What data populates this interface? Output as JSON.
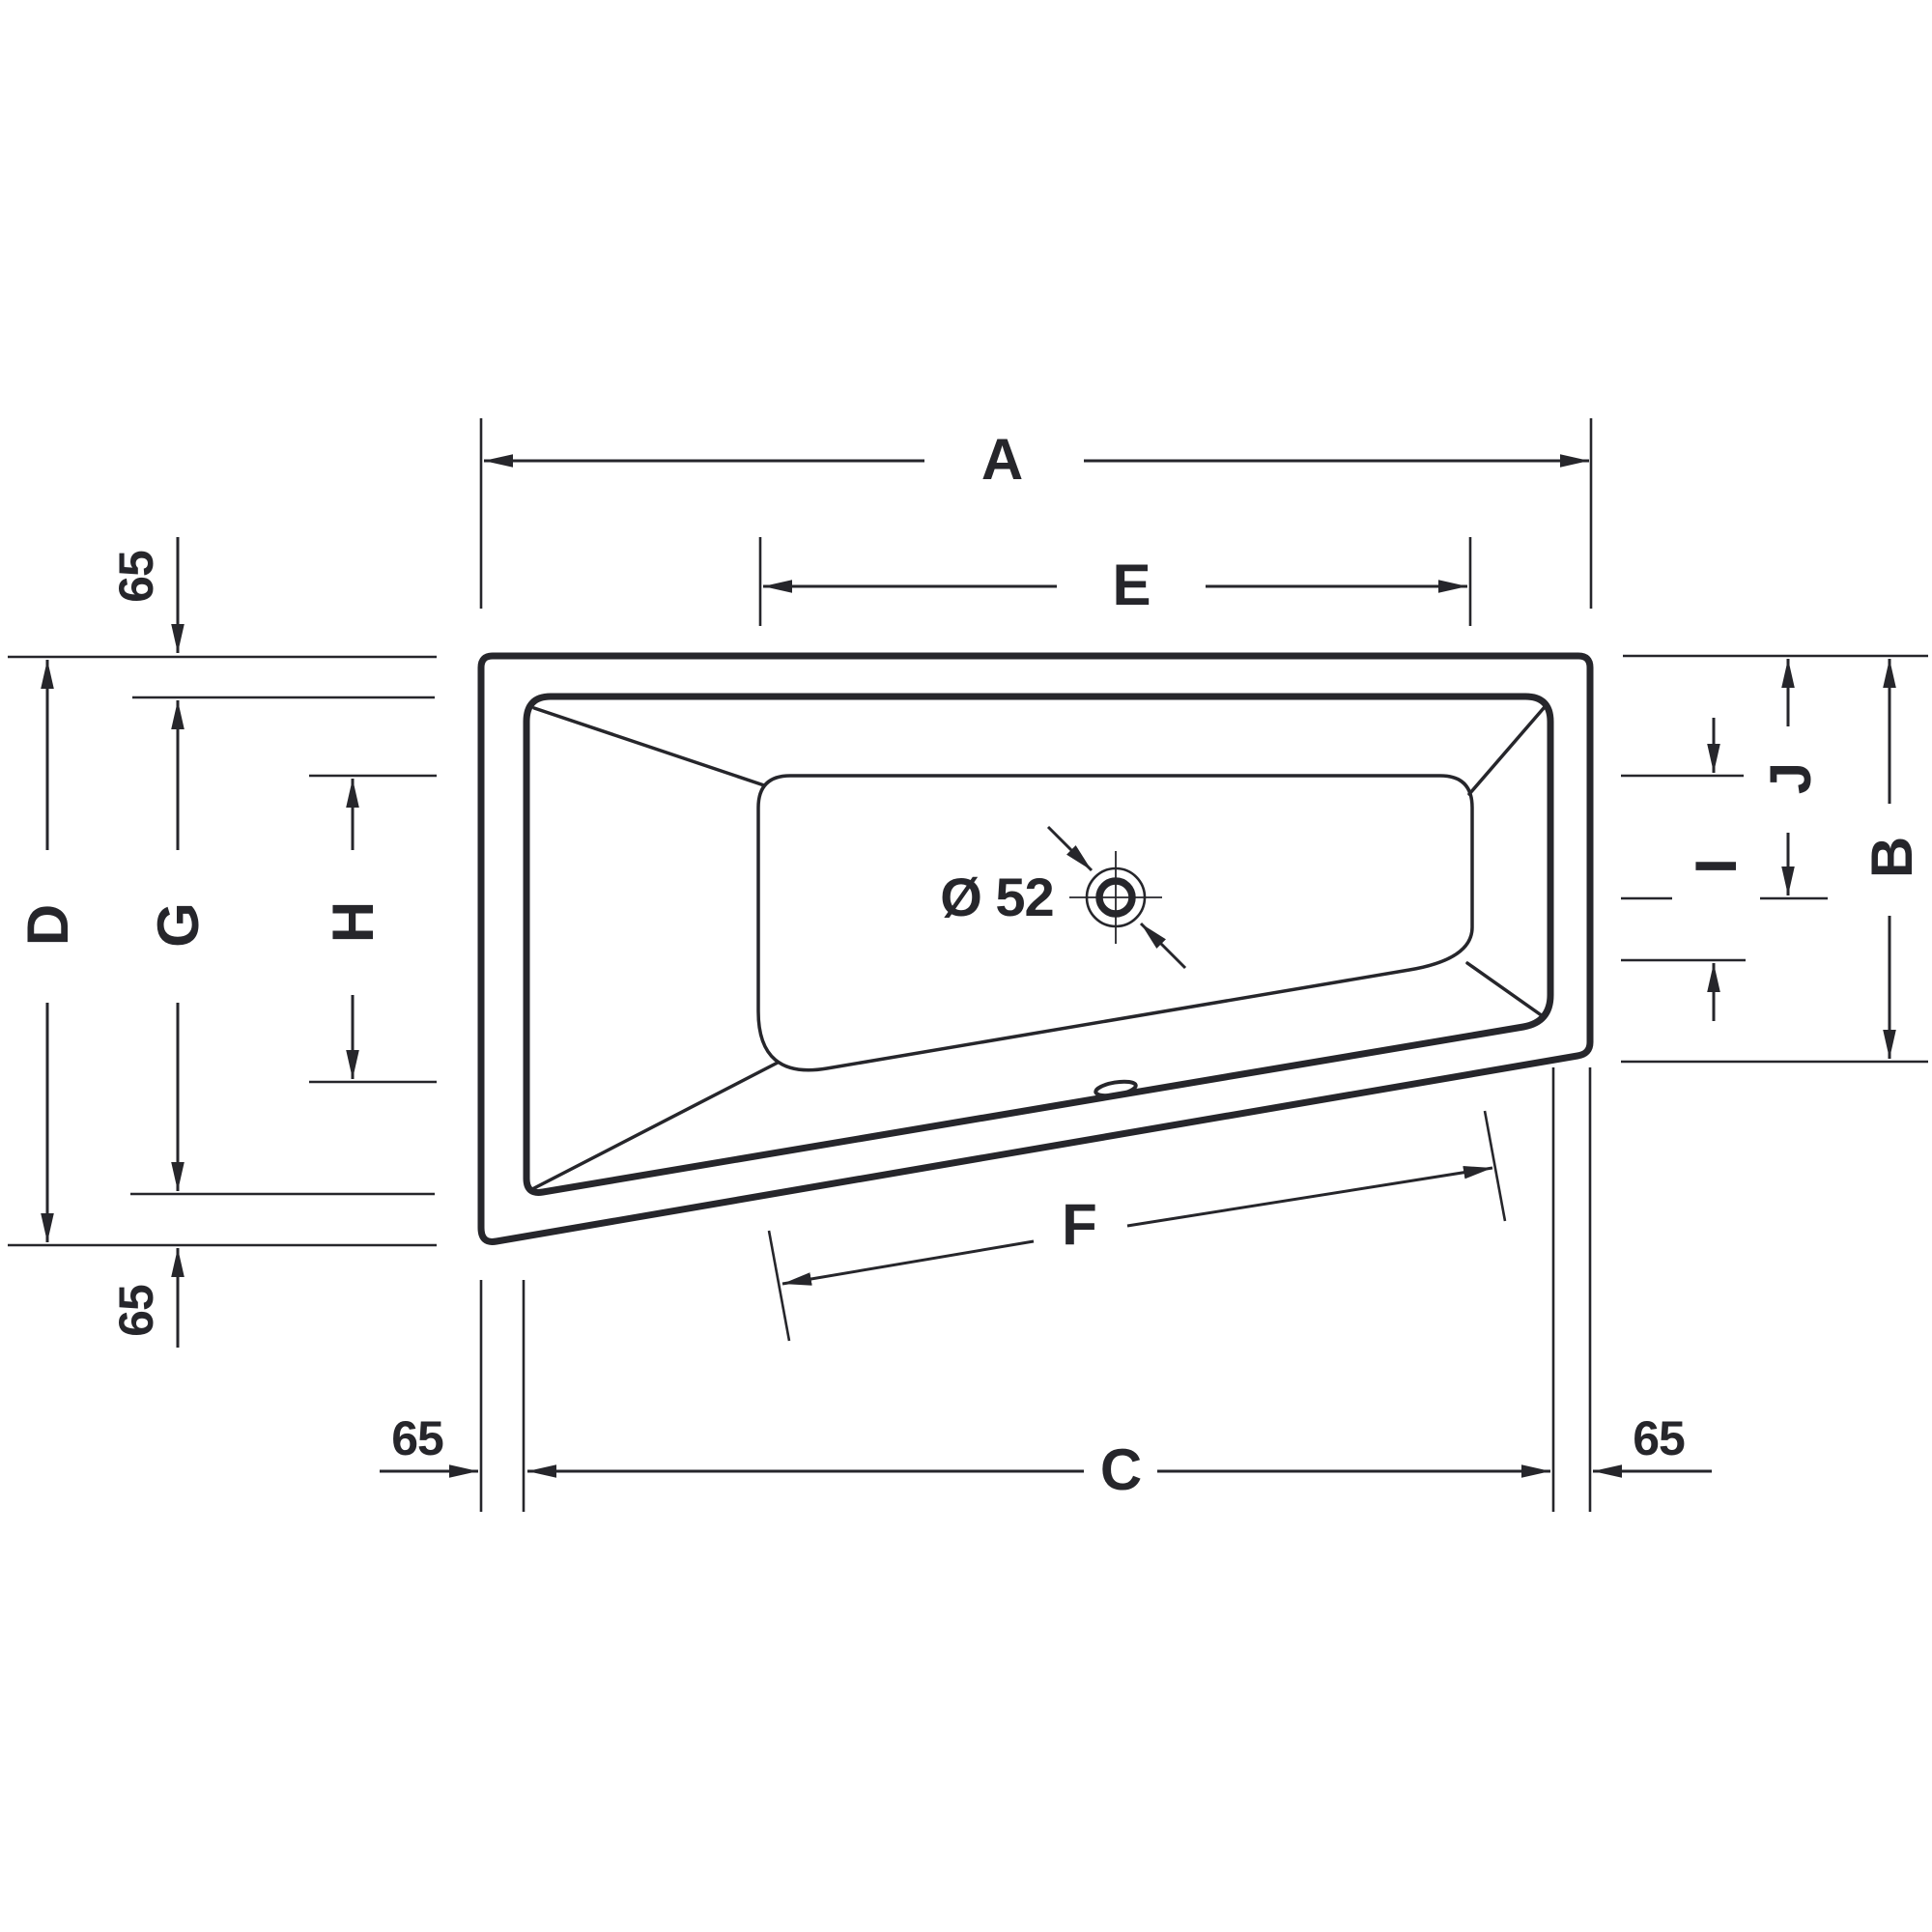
{
  "title": "Asymmetric bathtub top-view dimension drawing",
  "colors": {
    "ink": "#26262b",
    "background": "#ffffff"
  },
  "labels": {
    "length_overall": "A",
    "width_overall_right": "B",
    "length_inner_bottom": "C",
    "width_overall_left": "D",
    "length_floor_top": "E",
    "length_floor_bottom": "F",
    "width_inner_left": "G",
    "width_floor_left": "H",
    "width_floor_right": "I",
    "drain_center_offset": "J",
    "rim_width_top_left": "65",
    "rim_width_bottom_left": "65",
    "rim_width_bottom_left_horizontal": "65",
    "rim_width_bottom_right_horizontal": "65",
    "drain_diameter": "Ø 52"
  }
}
